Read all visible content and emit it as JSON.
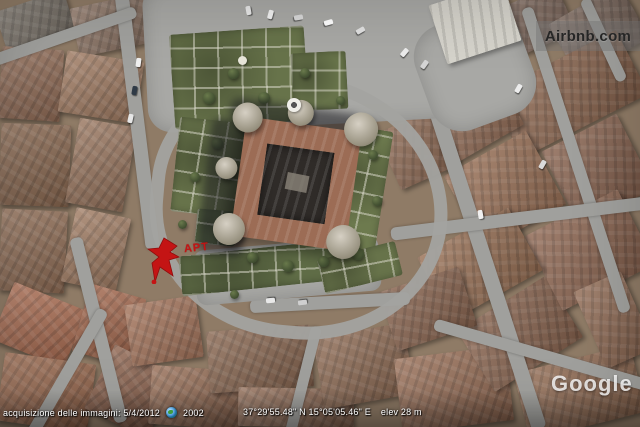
{
  "watermark": {
    "label": "Airbnb.com"
  },
  "marker": {
    "label": "APT",
    "color": "#c41414"
  },
  "status_bar": {
    "imagery_date": "acquisizione delle immagini: 5/4/2012",
    "history_year": "2002",
    "coordinates": "37°29'55.48\" N  15°05'05.46\" E",
    "elevation": "elev   28 m",
    "google_logo": "Google"
  },
  "icons": {
    "history_globe": {
      "name": "globe-icon",
      "color": "#2e86d4"
    }
  },
  "colors": {
    "marker_red": "#c41414",
    "watermark_bg": "rgba(115,115,115,0.45)",
    "watermark_text": "#262626",
    "status_text": "#ffffff",
    "google_logo_text": "rgba(255,255,255,0.8)",
    "rooftop_brown": "#96705a",
    "street_gray": "#a0a09d",
    "garden_green": "#67734a"
  }
}
